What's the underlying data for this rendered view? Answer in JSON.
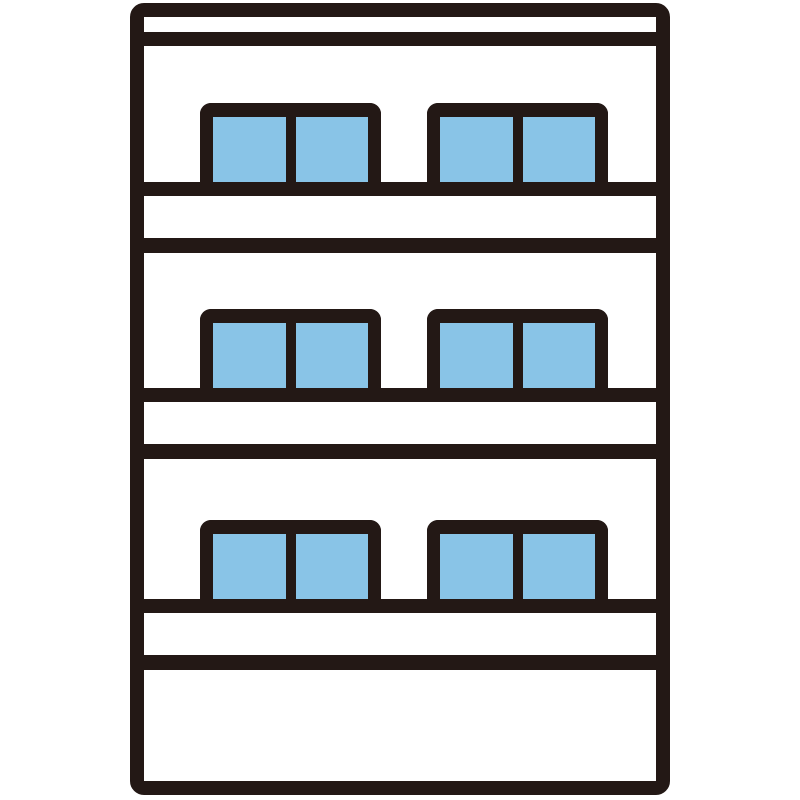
{
  "illustration": {
    "subject": "three-story apartment building clipart",
    "background_color": "#ffffff",
    "outline_color": "#231815",
    "window_glass_color": "#89c4e7",
    "building": {
      "floors": 3,
      "window_groups_per_floor": 2,
      "panes_per_group": 2,
      "has_roof_parapet_line": true,
      "has_blank_ground_floor": true
    }
  }
}
